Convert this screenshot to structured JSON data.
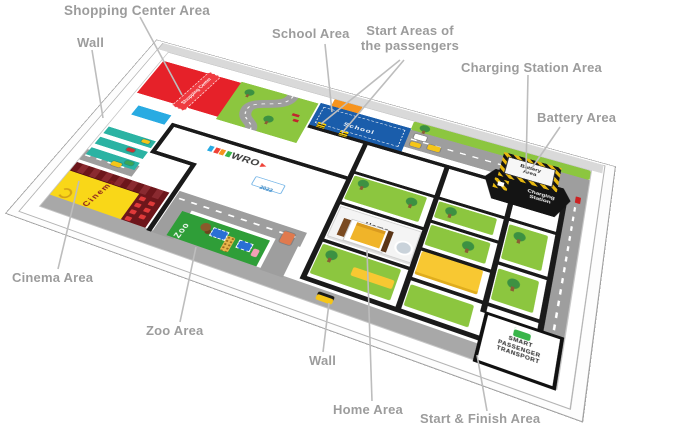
{
  "annotations": {
    "shopping_center": "Shopping Center Area",
    "wall_top": "Wall",
    "school": "School Area",
    "start_areas": "Start Areas of the passengers",
    "charging_station": "Charging Station Area",
    "battery": "Battery Area",
    "cinema": "Cinema Area",
    "zoo": "Zoo Area",
    "wall_bottom": "Wall",
    "home": "Home Area",
    "start_finish": "Start & Finish Area"
  },
  "mat": {
    "shopping_banner": "Shopping Center",
    "school_label": "School",
    "cinema_label": "Cinema",
    "zoo_label": "Zoo",
    "home_label": "Home",
    "battery_label": "Battery Area",
    "charging_label": "Charging Station",
    "start_finish_label": "SMART PASSENGER TRANSPORT",
    "wro_logo": "WRO",
    "wro_sub": "2022"
  },
  "colors": {
    "annotation_gray": "#9c9c9c",
    "leader_line": "#bdbdbd",
    "mat_green": "#8cc63f",
    "zoo_green": "#2f9e38",
    "school_blue": "#1a5dab",
    "shopping_red": "#e62129",
    "cinema_yellow": "#f9d718",
    "cinema_maroon": "#6d161b",
    "road_gray": "#9e9e9e",
    "line_black": "#1a1a1a",
    "marker_yellow": "#f8c832",
    "parking_teal": "#2bb3a3",
    "building_blue": "#29abe2",
    "building_orange": "#f7941e"
  }
}
